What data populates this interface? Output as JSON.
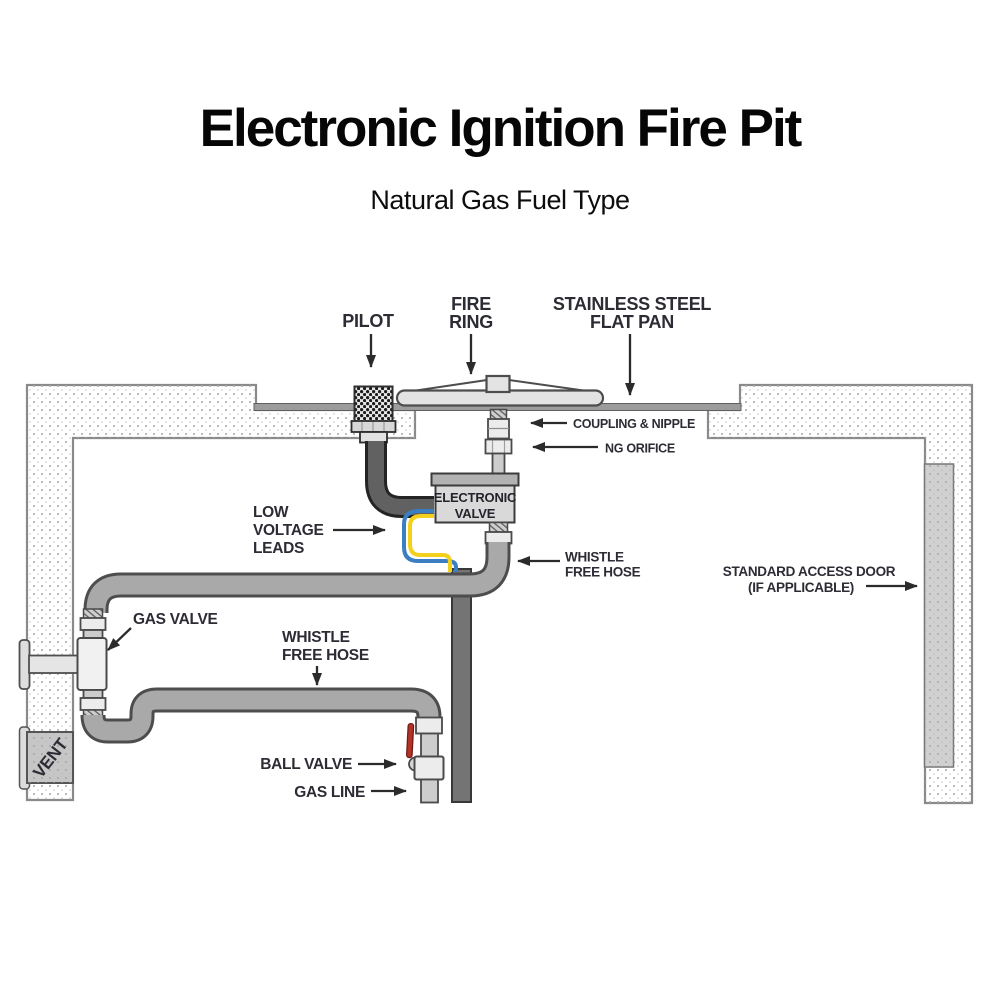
{
  "title": "Electronic Ignition Fire Pit",
  "subtitle": "Natural Gas Fuel Type",
  "labels": {
    "pilot": "PILOT",
    "fire_ring": {
      "line1": "FIRE",
      "line2": "RING"
    },
    "flat_pan": {
      "line1": "STAINLESS STEEL",
      "line2": "FLAT PAN"
    },
    "coupling_nipple": "COUPLING & NIPPLE",
    "ng_orifice": "NG ORIFICE",
    "electronic_valve": {
      "line1": "ELECTRONIC",
      "line2": "VALVE"
    },
    "whistle_free_hose_upper": {
      "line1": "WHISTLE",
      "line2": "FREE HOSE"
    },
    "standard_access_door": {
      "line1": "STANDARD ACCESS DOOR",
      "line2": "(IF APPLICABLE)"
    },
    "low_voltage_leads": {
      "line1": "LOW",
      "line2": "VOLTAGE",
      "line3": "LEADS"
    },
    "gas_valve": "GAS VALVE",
    "whistle_free_hose_lower": {
      "line1": "WHISTLE",
      "line2": "FREE HOSE"
    },
    "ball_valve": "BALL VALVE",
    "gas_line": "GAS LINE",
    "vent": "VENT"
  },
  "colors": {
    "hose_gray": "#a9a9a9",
    "hose_outline": "#4d4d4d",
    "conduit_gray": "#747474",
    "pilot_hose_dark": "#616161",
    "wire_blue": "#3b7ec2",
    "wire_yellow": "#f2d01c",
    "valve_lever_red": "#b23227",
    "label_text": "#2c2c34",
    "arrow": "#2b2b2b",
    "wall_outline": "#8a8a8a"
  }
}
